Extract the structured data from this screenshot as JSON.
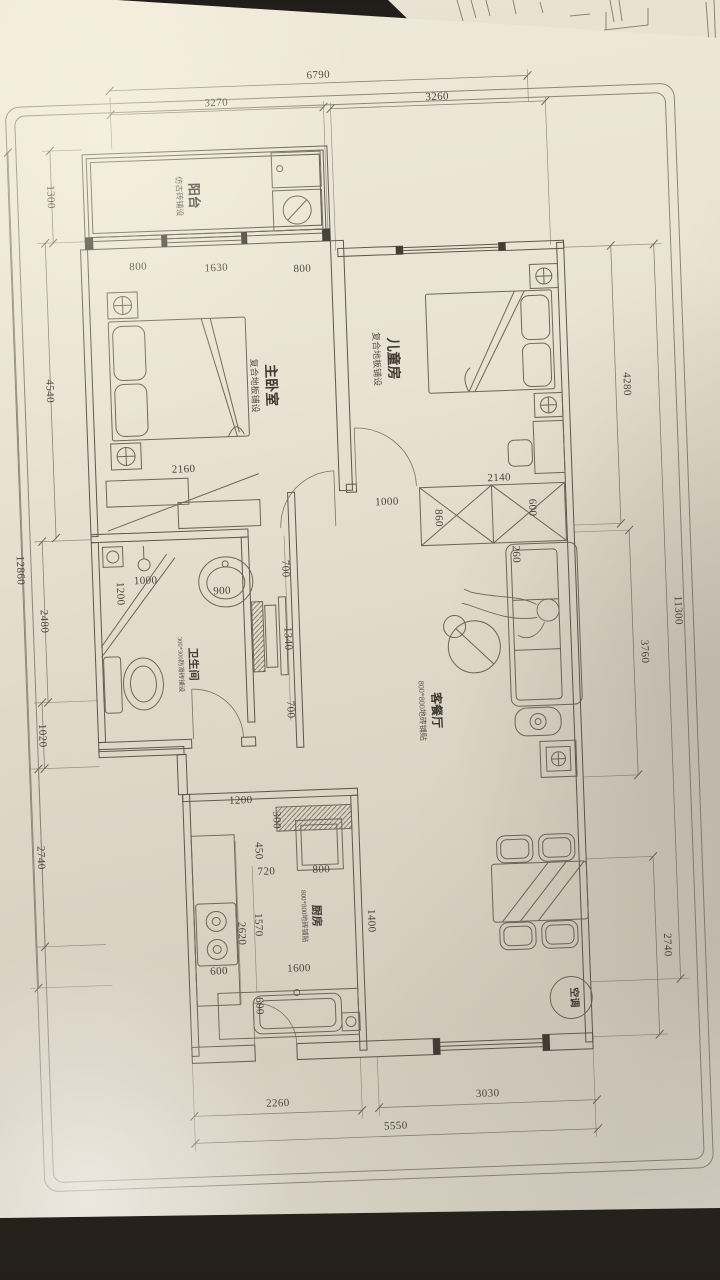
{
  "rooms": {
    "balcony": {
      "name": "阳台",
      "finish": "仿古砖铺设"
    },
    "master_bedroom": {
      "name": "主卧室",
      "finish": "复合地板铺设"
    },
    "kids_room": {
      "name": "儿童房",
      "finish": "复合地板铺设"
    },
    "bathroom": {
      "name": "卫生间",
      "finish": "300*300防滑砖铺设"
    },
    "living_dining": {
      "name": "客餐厅",
      "finish": "800*800地砖铺贴"
    },
    "kitchen": {
      "name": "厨房",
      "finish": "800*800地砖铺贴"
    },
    "ac_unit": {
      "name": "空调"
    }
  },
  "dimensions": {
    "top": {
      "overall": "6790",
      "left": "3270",
      "right": "3260"
    },
    "left": {
      "balcony": "1300",
      "bedroom": "4540",
      "d2480": "2480",
      "d1020": "1020",
      "d2740": "2740",
      "overall": "12860"
    },
    "right": {
      "d4280": "4280",
      "d3760": "3760",
      "d2740": "2740",
      "overall": "11300"
    },
    "bottom": {
      "kitchen": "2260",
      "living": "3030",
      "overall": "5550"
    },
    "interior": {
      "m800a": "800",
      "m1630": "1630",
      "m800b": "800",
      "m2160": "2160",
      "h1000": "1000",
      "c2140": "2140",
      "c860": "860",
      "c600": "600",
      "c260": "260",
      "b1200": "1200",
      "b1000": "1000",
      "b900": "900",
      "n700a": "700",
      "n1340": "1340",
      "n700b": "700",
      "k1200": "1200",
      "k300": "300",
      "k450": "450",
      "k720": "720",
      "k800": "800",
      "k1570": "1570",
      "k2620": "2620",
      "k600a": "600",
      "k1600": "1600",
      "k600b": "600",
      "k1400": "1400"
    }
  },
  "colors": {
    "paper": "#e9e2d2",
    "wall_line": "#5d564c",
    "dim_line": "#8a8275",
    "text": "#49433b",
    "table": "#272320"
  }
}
